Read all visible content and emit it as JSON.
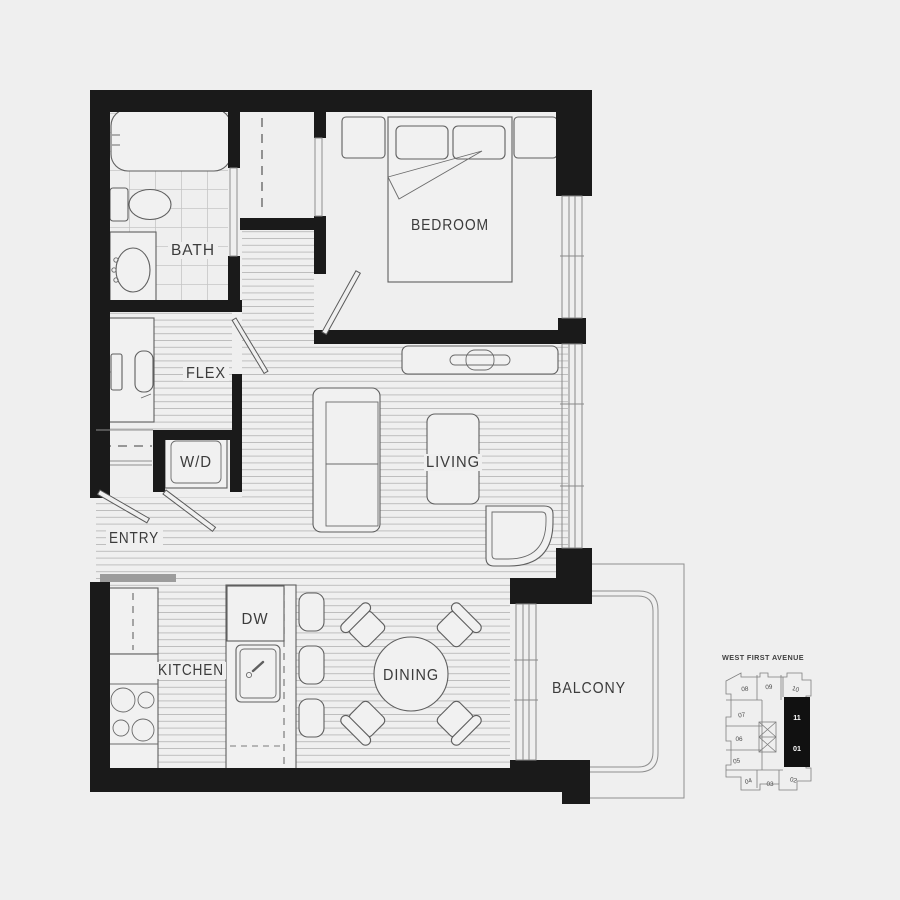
{
  "floor_plan": {
    "room_labels": {
      "bath": "BATH",
      "bedroom": "BEDROOM",
      "flex": "FLEX",
      "washer_dryer": "W/D",
      "entry": "ENTRY",
      "living": "LIVING",
      "kitchen": "KITCHEN",
      "dishwasher": "DW",
      "dining": "DINING",
      "balcony": "BALCONY"
    },
    "colors": {
      "background": "#efefef",
      "walls": "#1a1a1a",
      "fixture_lines": "#5f5f5f",
      "floor_hatch": "#b9b9b9",
      "highlighted_unit": "#111111"
    }
  },
  "key_plan": {
    "street_label": "WEST FIRST AVENUE",
    "units": [
      "08",
      "09",
      "10",
      "07",
      "06",
      "05",
      "04",
      "03",
      "02"
    ],
    "highlighted_units": [
      "11",
      "01"
    ]
  }
}
